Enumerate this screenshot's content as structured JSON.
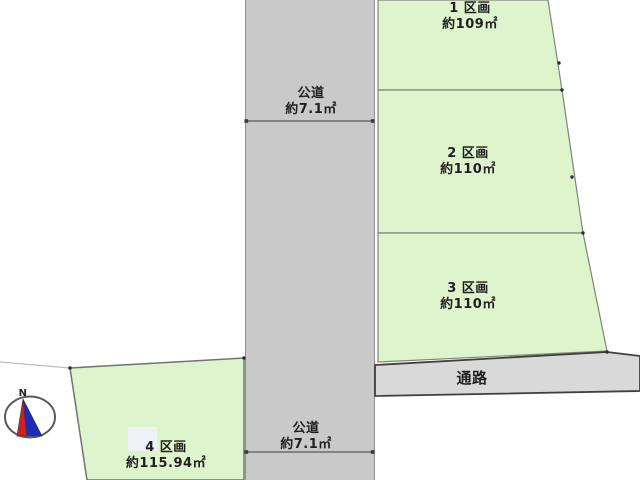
{
  "figure": {
    "type": "land-plot-layout-diagram",
    "orientation_mark": "N"
  },
  "colors": {
    "background": "#ffffff",
    "plot_fill": "#def4cc",
    "plot_stroke": "#80857b",
    "road_fill": "#c9c9c9",
    "road_edge": "#909090",
    "passage_fill": "#d9d9d9",
    "passage_stroke": "#3f3f3f",
    "dimension": "#3a3a3a",
    "text": "#1f1f1f",
    "compass_red": "#d01f24",
    "compass_blue": "#1b2bba",
    "highlight_box": "#edf2f7"
  },
  "road_labels": {
    "top": {
      "name": "公道",
      "size": "約7.1㎡"
    },
    "bottom": {
      "name": "公道",
      "size": "約7.1㎡"
    }
  },
  "passage": {
    "label": "通路"
  },
  "plots": [
    {
      "label": "1 区画",
      "area": "約109㎡"
    },
    {
      "label": "2 区画",
      "area": "約110㎡"
    },
    {
      "label": "3 区画",
      "area": "約110㎡"
    },
    {
      "label": "4 区画",
      "area": "約115.94㎡"
    }
  ],
  "compass": {
    "north_label": "N"
  }
}
